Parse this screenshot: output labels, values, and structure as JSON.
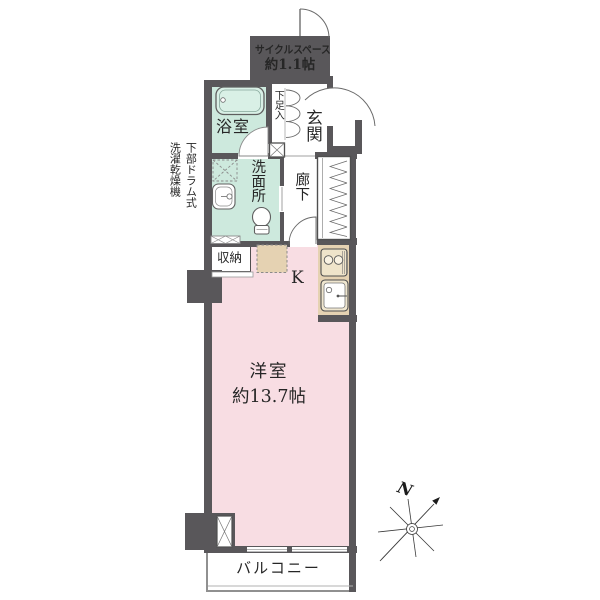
{
  "plan": {
    "type": "japanese-apartment-floor-plan",
    "colors": {
      "wall": "#59575a",
      "wet_area_floor": "#cde9dd",
      "main_room_floor": "#f8dde3",
      "kitchen_counter": "#e5d2b2",
      "balcony_border": "#909090",
      "text": "#262626"
    },
    "rooms": {
      "cycle_space": {
        "name": "サイクルスペース",
        "size": "約1.1帖"
      },
      "bathroom": {
        "label": "浴室"
      },
      "shoe_box": {
        "label": "下足入"
      },
      "entrance": {
        "label": "玄関"
      },
      "hallway": {
        "label": "廊下"
      },
      "washroom": {
        "label": "洗面所"
      },
      "storage": {
        "label": "収納"
      },
      "kitchen": {
        "label": "K"
      },
      "western_room": {
        "label": "洋室",
        "size": "約13.7帖"
      },
      "balcony": {
        "label": "バルコニー"
      }
    },
    "notes": {
      "washer_line1": "下部ドラム式",
      "washer_line2": "洗濯乾燥機"
    },
    "compass": {
      "north": "N"
    }
  }
}
